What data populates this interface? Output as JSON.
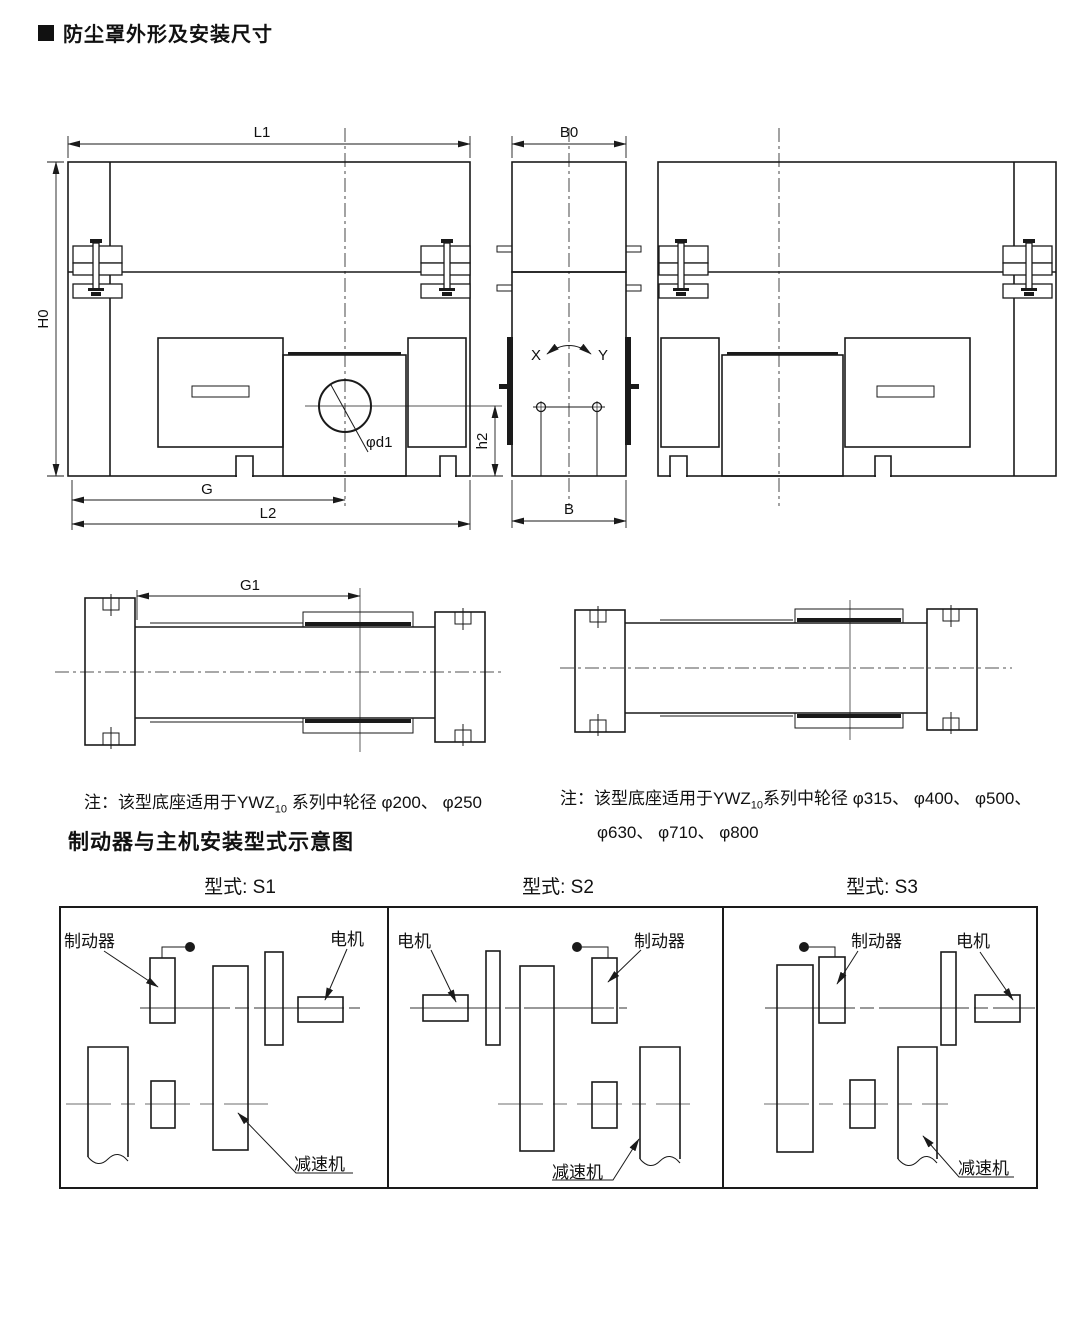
{
  "colors": {
    "line": "#1a1a1a",
    "background": "#ffffff",
    "centerline_gray": "#8a8a8a"
  },
  "header": {
    "title": "防尘罩外形及安装尺寸"
  },
  "drawing": {
    "dims": {
      "L1": "L1",
      "B0": "B0",
      "H0": "H0",
      "G": "G",
      "L2": "L2",
      "B": "B",
      "h2": "h2",
      "d1": "φd1",
      "G1": "G1",
      "X": "X",
      "Y": "Y"
    }
  },
  "notes": {
    "left": {
      "prefix": "注：该型底座适用于YWZ",
      "sub": "10",
      "suffix": " 系列中轮径 φ200、 φ250"
    },
    "right": {
      "prefix": "注：该型底座适用于YWZ",
      "sub": "10",
      "suffix": "系列中轮径 φ315、 φ400、 φ500、",
      "line2": "φ630、 φ710、 φ800"
    }
  },
  "section": {
    "title": "制动器与主机安装型式示意图"
  },
  "types": {
    "s1": "型式: S1",
    "s2": "型式: S2",
    "s3": "型式: S3"
  },
  "labels": {
    "brake": "制动器",
    "motor": "电机",
    "reducer": "减速机"
  }
}
